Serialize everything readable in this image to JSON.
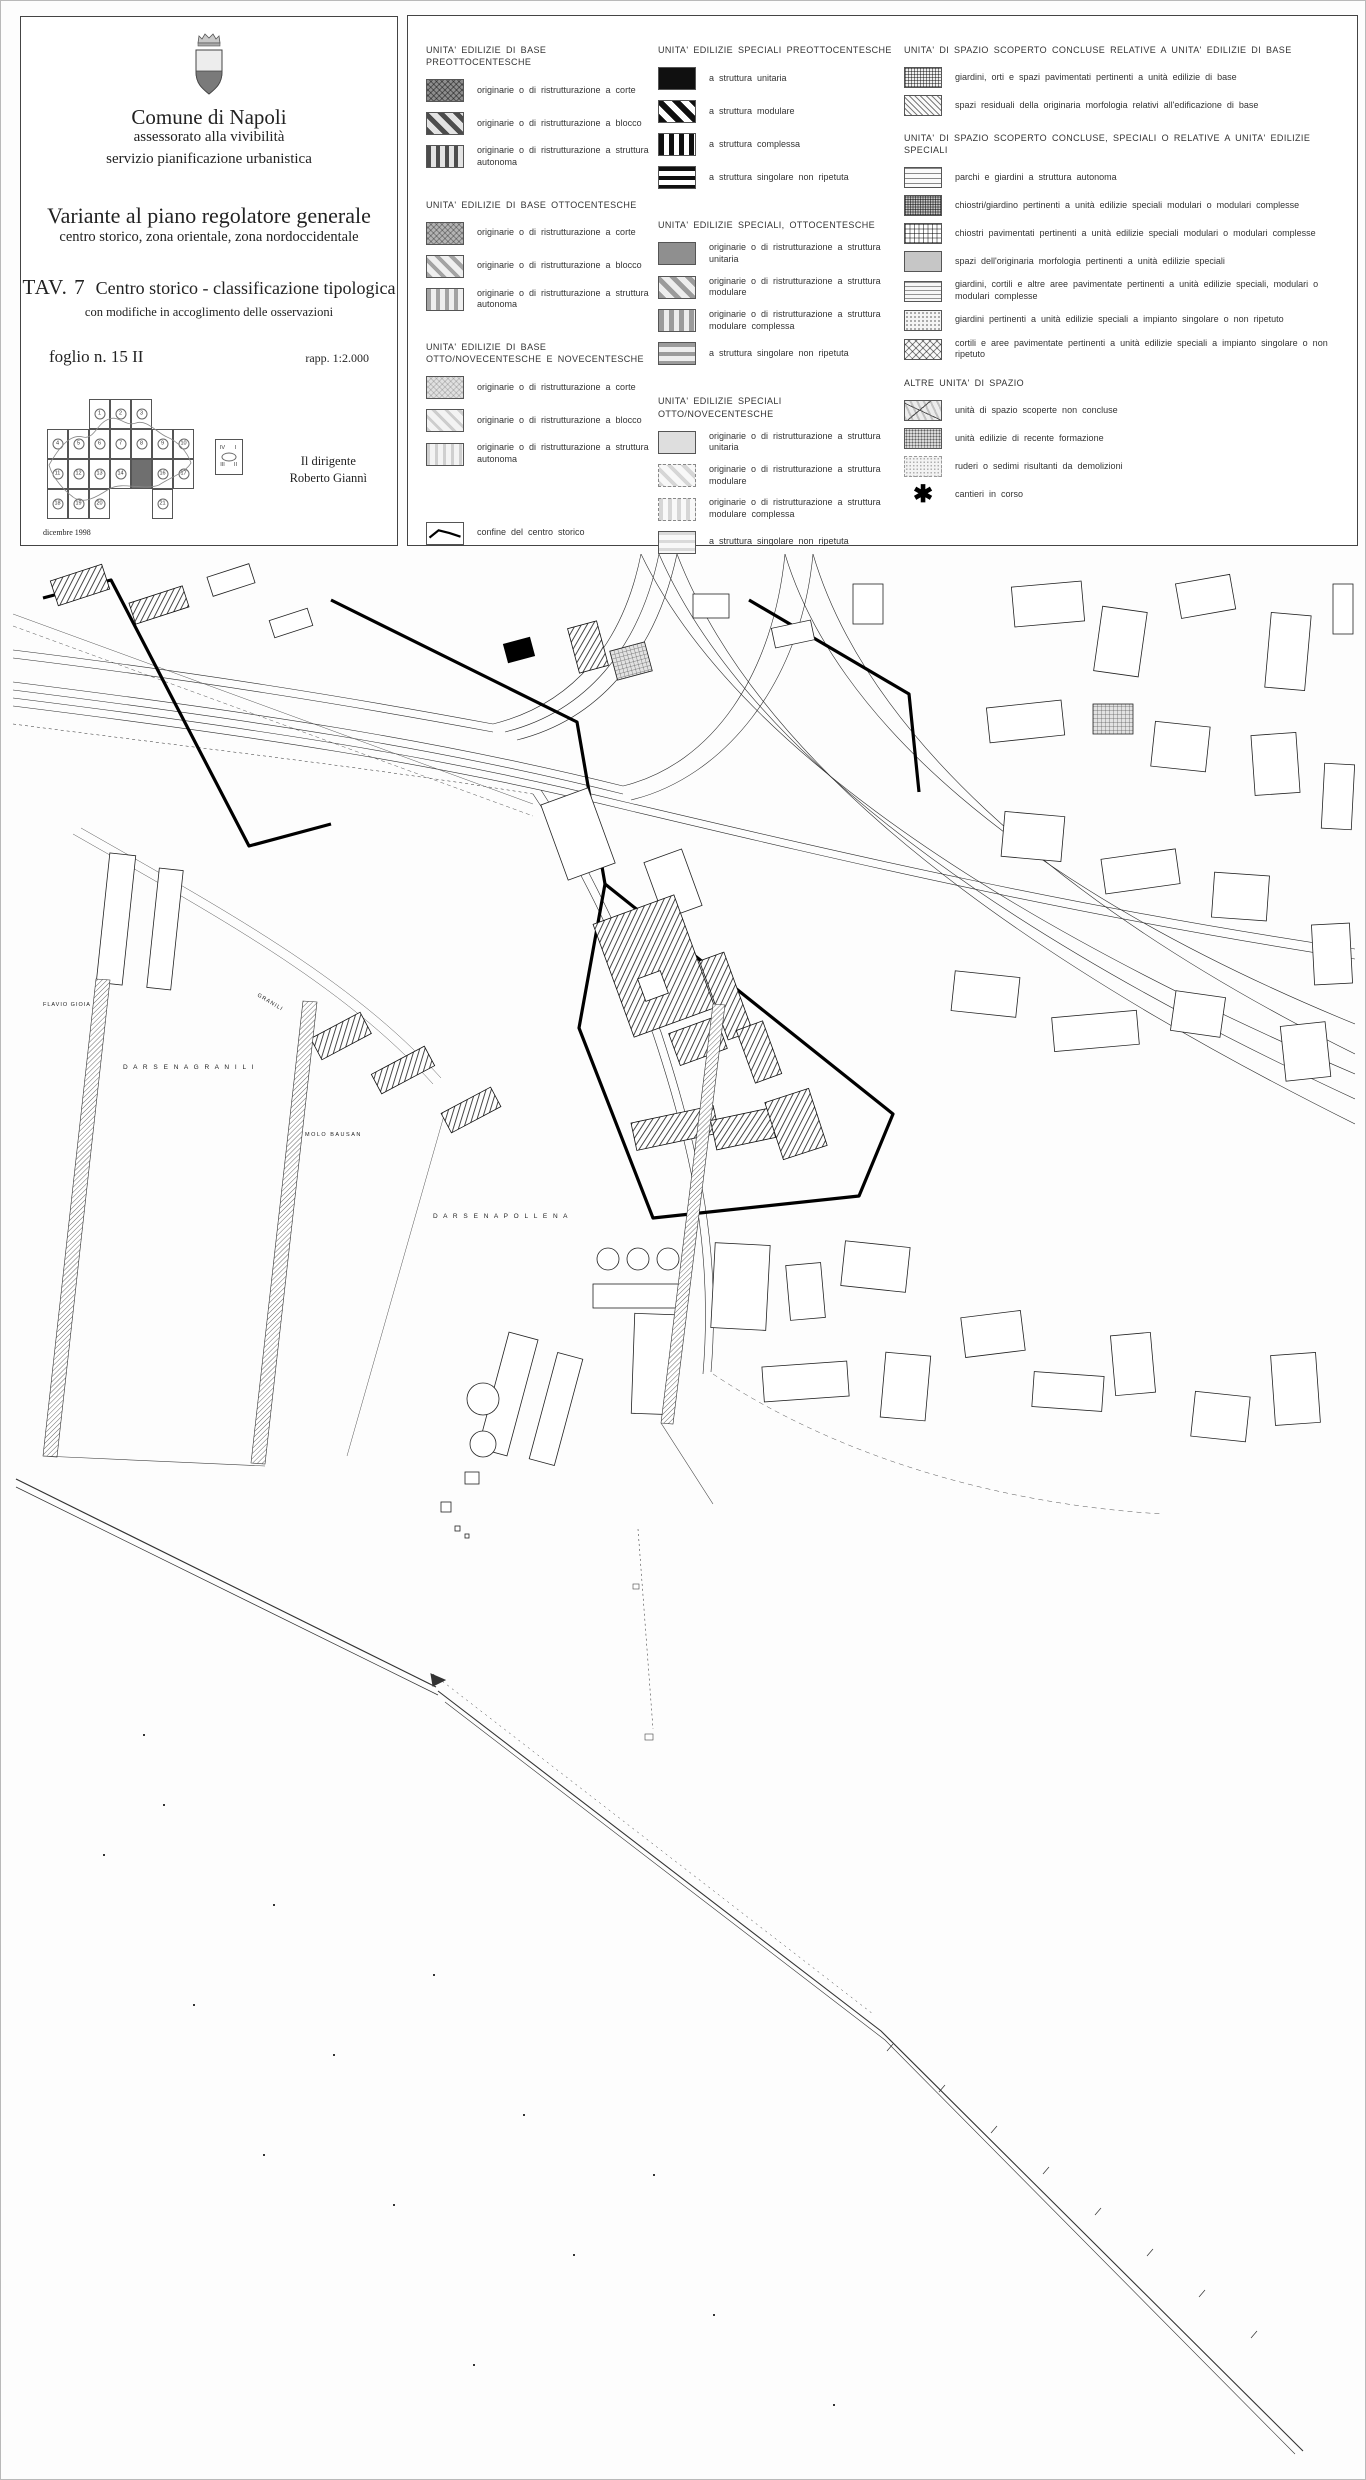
{
  "title_block": {
    "municipality": "Comune di Napoli",
    "department": "assessorato alla vivibilità",
    "office": "servizio pianificazione urbanistica",
    "plan_title": "Variante al piano regolatore generale",
    "plan_subtitle": "centro storico, zona orientale, zona nordoccidentale",
    "sheet_code": "TAV. 7",
    "sheet_title": "Centro storico - classificazione tipologica",
    "sheet_note": "con modifiche in accoglimento delle osservazioni",
    "folio": "foglio n. 15 II",
    "scale": "rapp. 1:2.000",
    "signature_role": "Il dirigente",
    "signature_name": "Roberto Giannì",
    "date": "dicembre 1998",
    "highlighted_sheet": "15",
    "index_grid": [
      [
        "",
        "",
        "1",
        "2",
        "3",
        "",
        ""
      ],
      [
        "4",
        "5",
        "6",
        "7",
        "8",
        "9",
        "10"
      ],
      [
        "11",
        "12",
        "13",
        "14",
        "15",
        "16",
        "17"
      ],
      [
        "18",
        "19",
        "20",
        "",
        "",
        "21",
        ""
      ]
    ],
    "index_quadrants": [
      "IV",
      "I",
      "III",
      "II"
    ]
  },
  "legend": {
    "columns": [
      {
        "sections": [
          {
            "header": "UNITA' EDILIZIE DI BASE PREOTTOCENTESCHE",
            "items": [
              {
                "pattern": "sw-xhatch-dark",
                "label": "originarie o di ristrutturazione a corte"
              },
              {
                "pattern": "sw-diag-dark",
                "label": "originarie o di ristrutturazione a blocco"
              },
              {
                "pattern": "sw-vert-dark",
                "label": "originarie o di ristrutturazione a struttura autonoma"
              }
            ]
          },
          {
            "header": "UNITA' EDILIZIE DI BASE OTTOCENTESCHE",
            "items": [
              {
                "pattern": "sw-xhatch-mid",
                "label": "originarie o di ristrutturazione a corte"
              },
              {
                "pattern": "sw-diag-mid",
                "label": "originarie o di ristrutturazione a blocco"
              },
              {
                "pattern": "sw-vert-mid",
                "label": "originarie o di ristrutturazione a struttura autonoma"
              }
            ]
          },
          {
            "header": "UNITA' EDILIZIE DI BASE OTTO/NOVECENTESCHE E NOVECENTESCHE",
            "items": [
              {
                "pattern": "sw-xhatch-light",
                "label": "originarie o di ristrutturazione a corte"
              },
              {
                "pattern": "sw-diag-light",
                "label": "originarie o di ristrutturazione a blocco"
              },
              {
                "pattern": "sw-vert-light",
                "label": "originarie o di ristrutturazione a struttura autonoma"
              },
              {
                "pattern": "sw-boundary",
                "label": "confine del centro storico",
                "gap_before": true,
                "icon_name": "boundary-line-swatch"
              }
            ]
          }
        ]
      },
      {
        "sections": [
          {
            "header": "UNITA' EDILIZIE SPECIALI PREOTTOCENTESCHE",
            "items": [
              {
                "pattern": "sw-solid-black",
                "label": "a struttura unitaria"
              },
              {
                "pattern": "sw-diag-black",
                "label": "a struttura modulare"
              },
              {
                "pattern": "sw-vert-black",
                "label": "a struttura complessa"
              },
              {
                "pattern": "sw-horiz-black",
                "label": "a struttura singolare non ripetuta"
              }
            ]
          },
          {
            "header": "UNITA' EDILIZIE SPECIALI, OTTOCENTESCHE",
            "items": [
              {
                "pattern": "sw-solid-gray",
                "label": "originarie o di ristrutturazione a struttura unitaria"
              },
              {
                "pattern": "sw-diag-gray",
                "label": "originarie o di ristrutturazione a struttura modulare"
              },
              {
                "pattern": "sw-vert-gray",
                "label": "originarie o di ristrutturazione a struttura modulare complessa"
              },
              {
                "pattern": "sw-horiz-gray",
                "label": "a struttura singolare non ripetuta"
              }
            ]
          },
          {
            "header": "UNITA' EDILIZIE SPECIALI OTTO/NOVECENTESCHE",
            "items": [
              {
                "pattern": "sw-solid-pale",
                "label": "originarie o di ristrutturazione a struttura unitaria"
              },
              {
                "pattern": "sw-diag-pale",
                "label": "originarie o di ristrutturazione a struttura modulare"
              },
              {
                "pattern": "sw-vert-pale",
                "label": "originarie o di ristrutturazione a struttura modulare complessa"
              },
              {
                "pattern": "sw-horiz-pale",
                "label": "a struttura singolare non ripetuta"
              }
            ]
          }
        ]
      },
      {
        "sections": [
          {
            "header": "UNITA' DI SPAZIO SCOPERTO CONCLUSE RELATIVE A UNITA' EDILIZIE DI BASE",
            "items": [
              {
                "pattern": "sw-grid-fine",
                "label": "giardini, orti e spazi pavimentati pertinenti a unità edilizie di base"
              },
              {
                "pattern": "sw-hatch-fine",
                "label": "spazi residuali della originaria morfologia relativi all'edificazione di base"
              }
            ]
          },
          {
            "header": "UNITA' DI SPAZIO SCOPERTO CONCLUSE, SPECIALI O RELATIVE A UNITA' EDILIZIE SPECIALI",
            "items": [
              {
                "pattern": "sw-lines-horiz",
                "label": "parchi e giardini a struttura autonoma"
              },
              {
                "pattern": "sw-grid-dense",
                "label": "chiostri/giardino pertinenti a unità edilizie speciali modulari o modulari complesse"
              },
              {
                "pattern": "sw-grid-open",
                "label": "chiostri pavimentati pertinenti a unità edilizie speciali modulari o modulari complesse"
              },
              {
                "pattern": "sw-solid-pale3",
                "label": "spazi dell'originaria morfologia pertinenti a unità edilizie speciali"
              },
              {
                "pattern": "sw-lines-horiz2",
                "label": "giardini, cortili e altre aree pavimentate pertinenti a unità edilizie speciali, modulari o modulari complesse"
              },
              {
                "pattern": "sw-dots-light",
                "label": "giardini pertinenti a unità edilizie speciali a impianto singolare o non ripetuto"
              },
              {
                "pattern": "sw-diamond",
                "label": "cortili e aree pavimentate pertinenti a unità edilizie speciali a impianto singolare o non ripetuto"
              }
            ]
          },
          {
            "header": "ALTRE UNITA' DI SPAZIO",
            "items": [
              {
                "pattern": "sw-irregular",
                "label": "unità di spazio scoperte non concluse"
              },
              {
                "pattern": "sw-dots-dense",
                "label": "unità edilizie di recente formazione"
              },
              {
                "pattern": "sw-dots-pale",
                "label": "ruderi o sedimi risultanti da demolizioni"
              },
              {
                "symbol": "✱",
                "label": "cantieri in corso",
                "icon_name": "asterisk-icon"
              }
            ]
          }
        ]
      }
    ]
  },
  "map": {
    "labels": [
      {
        "text": "D A R S E N A   G R A N I L I"
      },
      {
        "text": "MOLO  BAUSAN"
      },
      {
        "text": "D A R S E N A   P O L L E N A"
      },
      {
        "text": "FLAVIO  GIOIA"
      },
      {
        "text": "GRANILI"
      }
    ]
  }
}
